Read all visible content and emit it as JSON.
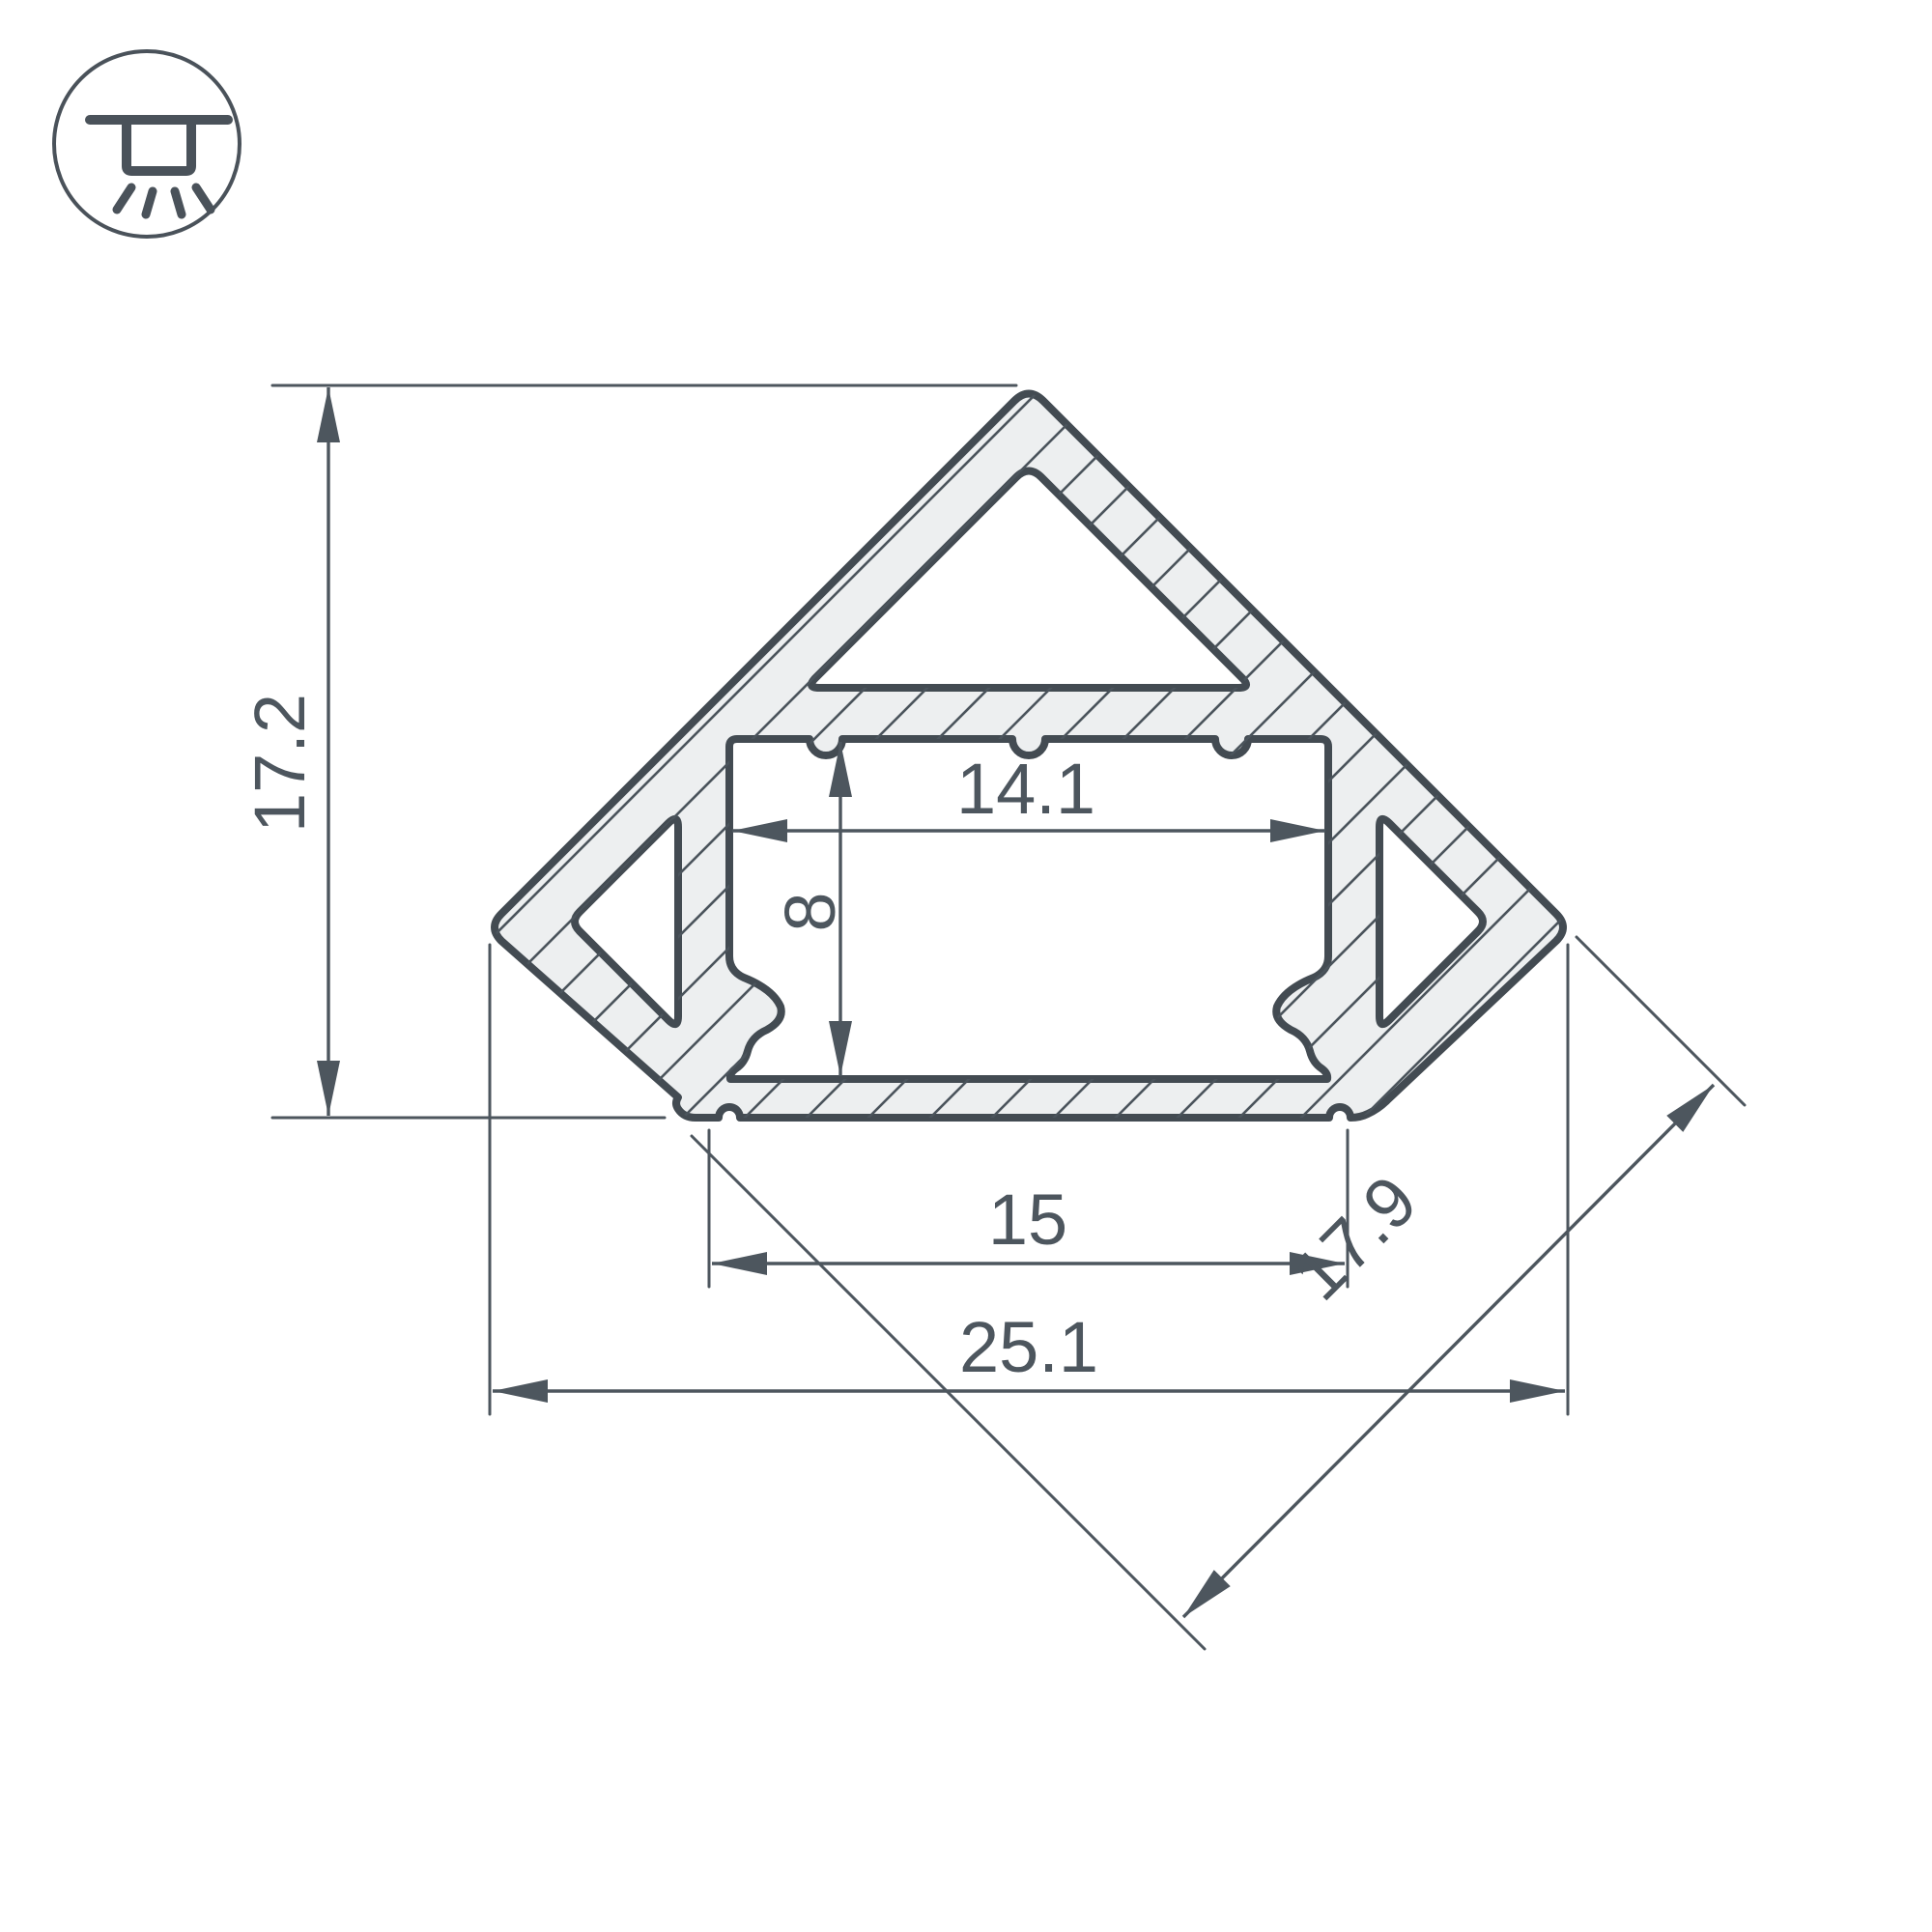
{
  "drawing": {
    "type": "led-profile-cross-section",
    "dimensions": {
      "overall_height": "17.2",
      "channel_width": "14.1",
      "channel_depth": "8",
      "base_width": "15",
      "overall_width": "25.1",
      "diagonal_width": "17.9"
    },
    "icon": "ceiling-light",
    "colors": {
      "background": "#FFFFFF",
      "outline": "#434B52",
      "aluminum_fill": "#EDEFF0",
      "dimension": "#4D565E"
    }
  }
}
